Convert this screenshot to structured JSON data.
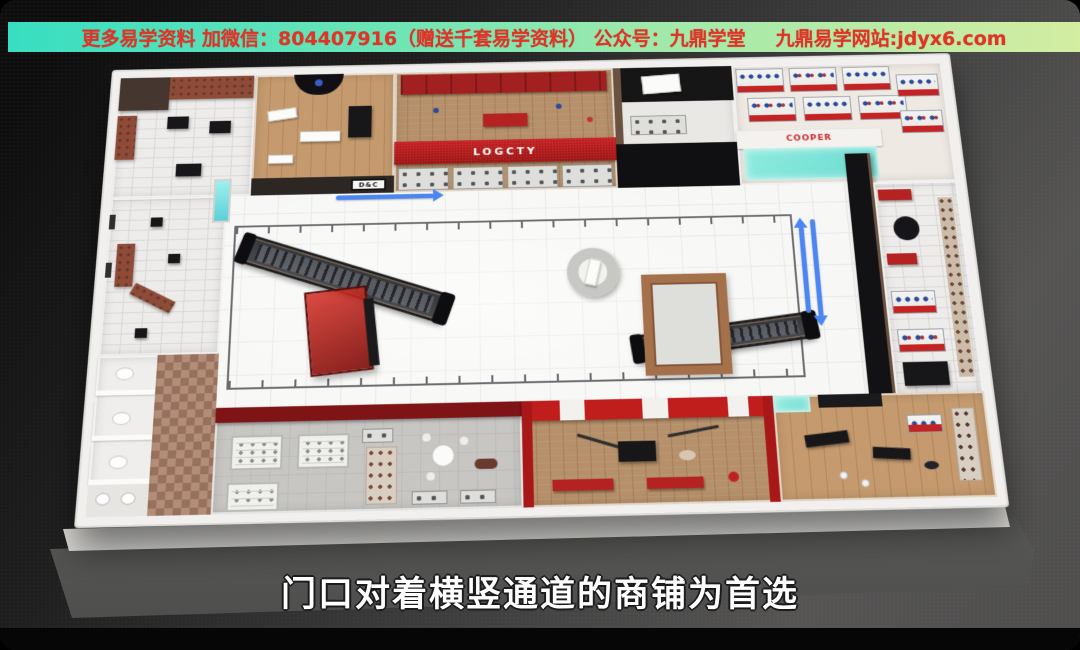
{
  "banner": {
    "text_main": "更多易学资料 加微信：804407916（赠送千套易学资料） 公众号：九鼎学堂",
    "text_site": "九鼎易学网站:jdyx6.com",
    "text_color": "#e23327",
    "bg_gradient_left": "#38dec1",
    "bg_gradient_right": "#d3eda1"
  },
  "subtitle": {
    "text": "门口对着横竖通道的商铺为首选",
    "color": "#ffffff"
  },
  "floorplan": {
    "signs": {
      "dc": "D&C",
      "logcty": "LOGCTY",
      "cooper": "COOPER"
    },
    "arrows": {
      "horizontal_aisle_direction": "right",
      "vertical_aisle_direction": "up-down",
      "color": "#4b86f2"
    },
    "accent_colors": {
      "store_sign_red": "#c51f1f",
      "storefront_dark_red": "#7e1416",
      "entrance_mat_cyan": "#7fe3d5",
      "wall_white": "#f1f0ee",
      "escalator_dark": "#34373c"
    }
  }
}
